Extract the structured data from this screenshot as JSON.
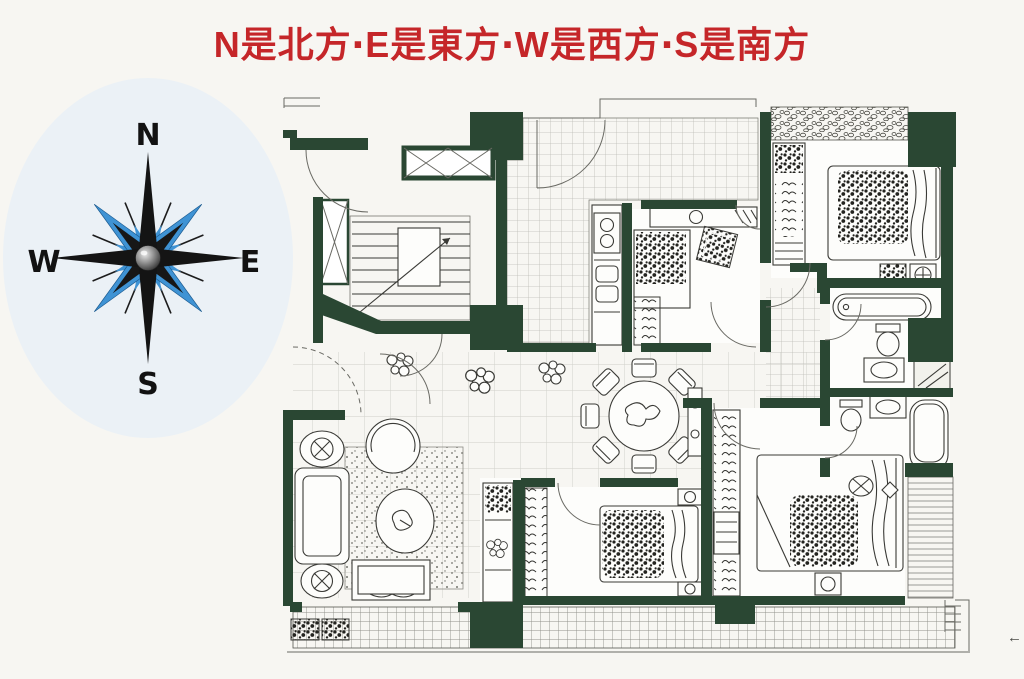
{
  "title": {
    "text": "N是北方‧E是東方‧W是西方‧S是南方"
  },
  "compass": {
    "labels": {
      "north": "N",
      "east": "E",
      "west": "W",
      "south": "S"
    },
    "colors": {
      "points_primary": "#161616",
      "points_secondary": "#3f93d4",
      "hub": "#8a8a8a"
    }
  },
  "floor_plan": {
    "wall_color": "#2a4733",
    "line_color": "#3a3a36",
    "features": [
      "stairwell",
      "elevator-shaft",
      "entry-foyer",
      "tiled-corridor",
      "kitchen-stove",
      "kitchen-sink",
      "dining-round-table",
      "dining-chairs",
      "living-sofa",
      "armchairs",
      "round-lounge-chair",
      "rug",
      "coffee-table",
      "tv-bench",
      "potted-plants",
      "bedroom-bed",
      "wardrobe-hanger-closets",
      "bathtub",
      "toilet",
      "wash-basin",
      "shower-block",
      "balcony-grid",
      "flower-boxes"
    ]
  },
  "corner_mark": "←",
  "page": {
    "background": "#f7f6f2",
    "title_color": "#c52629"
  }
}
